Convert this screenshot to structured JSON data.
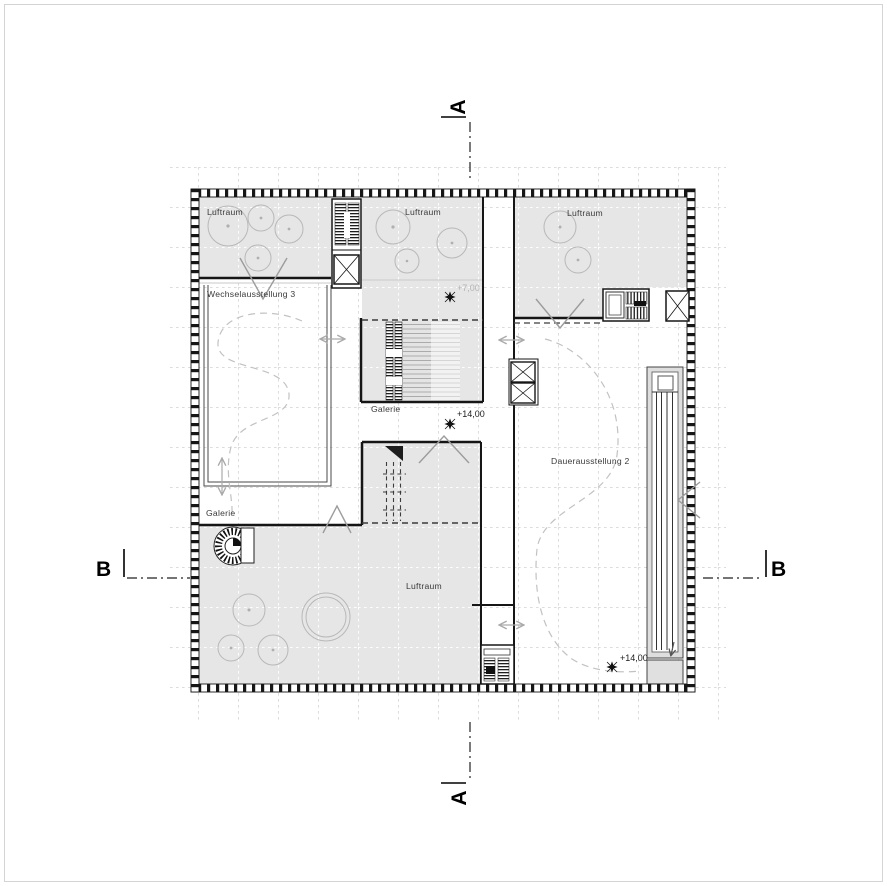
{
  "plan": {
    "type": "architectural-floor-plan",
    "rooms": {
      "luftraum_top_left": "Luftraum",
      "luftraum_top_center": "Luftraum",
      "luftraum_top_right": "Luftraum",
      "luftraum_bottom": "Luftraum",
      "wechselausstellung": "Wechselausstellung 3",
      "dauerausstellung": "Dauerausstellung 2",
      "galerie_center": "Galerie",
      "galerie_left": "Galerie"
    },
    "elevations": {
      "upper": "+7,00",
      "gallery_center": "+14,00",
      "gallery_right": "+14,00"
    },
    "section_markers": {
      "a_top": "A",
      "a_bottom": "A",
      "b_left": "B",
      "b_right": "B"
    },
    "colors": {
      "room_fill": "#e6e6e7",
      "ramp_fill": "#dedede",
      "wall": "#161616",
      "tree_stroke": "#b8b8b8",
      "path_dash": "#c2c2c2",
      "chevron": "#9c9c9c",
      "grid": "#dcdcdc",
      "frame": "#d4d4d4"
    }
  }
}
